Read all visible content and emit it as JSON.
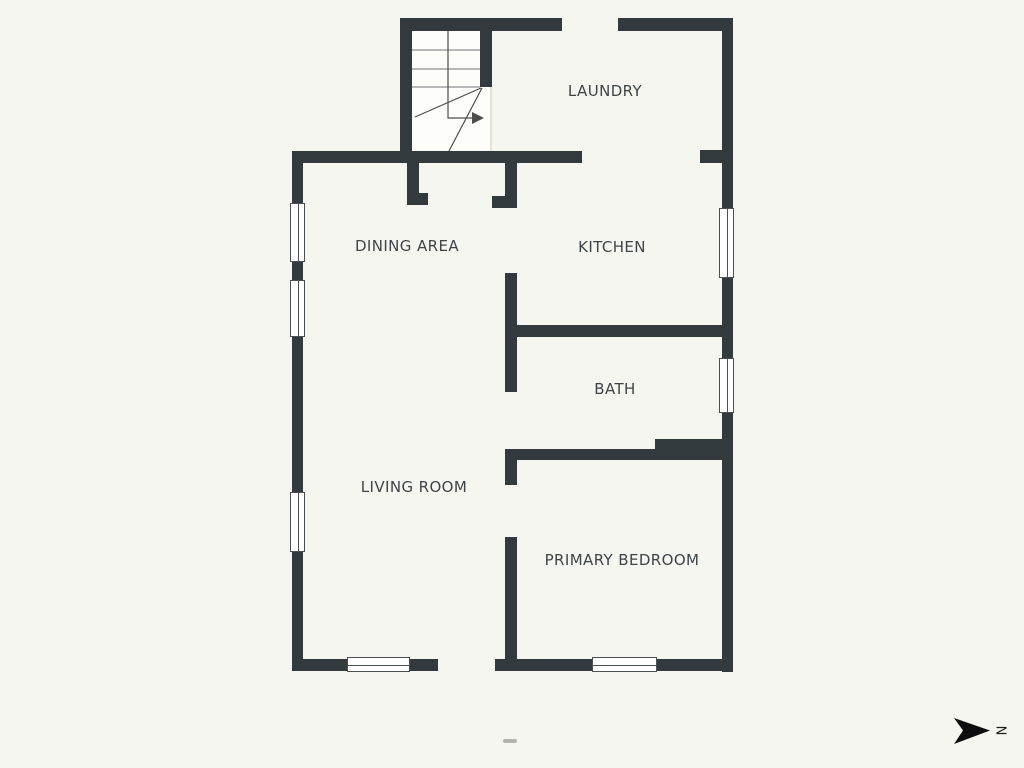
{
  "rooms": [
    {
      "id": "laundry",
      "label": "LAUNDRY"
    },
    {
      "id": "kitchen",
      "label": "KITCHEN"
    },
    {
      "id": "dining-area",
      "label": "DINING AREA"
    },
    {
      "id": "bath",
      "label": "BATH"
    },
    {
      "id": "living-room",
      "label": "LIVING ROOM"
    },
    {
      "id": "primary-bedroom",
      "label": "PRIMARY BEDROOM"
    }
  ],
  "compass": {
    "label": "N"
  },
  "colors": {
    "background": "#f6f6f0",
    "wall": "#333a3e",
    "text": "#3f4447",
    "stair_fill": "#fdfdf9",
    "stair_tread": "#8f9092",
    "stair_line": "#4d4d4d",
    "window_frame": "#4b5052",
    "window_fill": "#ffffff",
    "compass": "#0d0d0d",
    "watermark": "#7d7d74"
  }
}
